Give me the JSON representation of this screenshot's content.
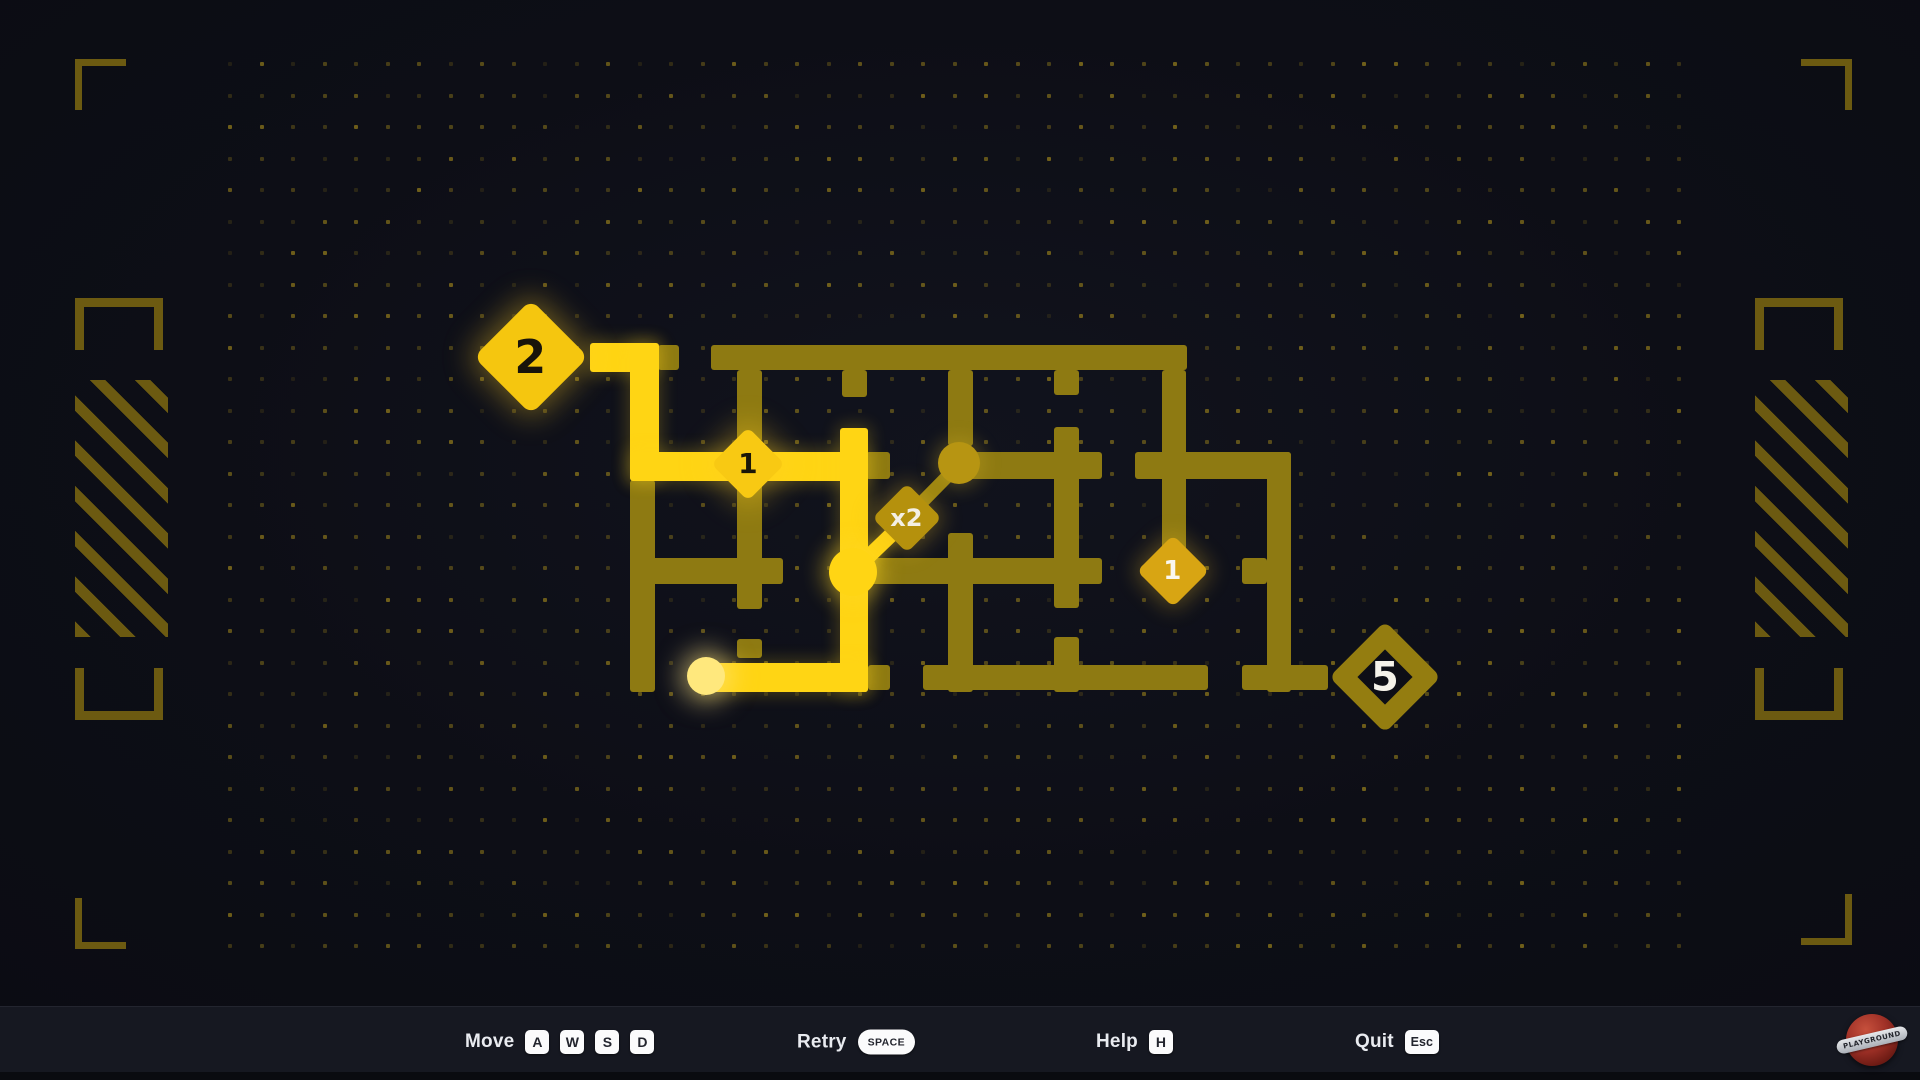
{
  "app": {
    "background": "#0d0e16",
    "footer_background": "#161821",
    "accent_bright": "#ffd514",
    "accent_dim": "#8e7a12",
    "accent_pale": "#ffe87d",
    "decor_color": "#6c5a11"
  },
  "logo": {
    "text": "PLAYGROUND"
  },
  "hud": {
    "controls": [
      {
        "label": "Move",
        "keys": [
          {
            "t": "A"
          },
          {
            "t": "W"
          },
          {
            "t": "S"
          },
          {
            "t": "D"
          }
        ]
      },
      {
        "label": "Retry",
        "keys": [
          {
            "t": "SPACE",
            "style": "pill"
          }
        ]
      },
      {
        "label": "Help",
        "keys": [
          {
            "t": "H"
          }
        ]
      },
      {
        "label": "Quit",
        "keys": [
          {
            "t": "Esc",
            "style": "wide"
          }
        ]
      }
    ]
  },
  "maze": {
    "bright_segments": [
      {
        "x": 590,
        "y": 343,
        "w": 66,
        "h": 29
      },
      {
        "x": 630,
        "y": 343,
        "w": 29,
        "h": 137
      },
      {
        "x": 630,
        "y": 452,
        "w": 238,
        "h": 29
      },
      {
        "x": 840,
        "y": 428,
        "w": 28,
        "h": 264
      },
      {
        "x": 702,
        "y": 663,
        "w": 166,
        "h": 29
      }
    ],
    "dim_segments": [
      {
        "x": 658,
        "y": 345,
        "w": 21,
        "h": 25
      },
      {
        "x": 711,
        "y": 345,
        "w": 476,
        "h": 25
      },
      {
        "x": 842,
        "y": 370,
        "w": 25,
        "h": 27
      },
      {
        "x": 737,
        "y": 370,
        "w": 25,
        "h": 72
      },
      {
        "x": 948,
        "y": 370,
        "w": 25,
        "h": 76
      },
      {
        "x": 1054,
        "y": 370,
        "w": 25,
        "h": 25
      },
      {
        "x": 1162,
        "y": 370,
        "w": 24,
        "h": 201
      },
      {
        "x": 866,
        "y": 452,
        "w": 24,
        "h": 27
      },
      {
        "x": 944,
        "y": 452,
        "w": 158,
        "h": 27
      },
      {
        "x": 1054,
        "y": 427,
        "w": 25,
        "h": 181
      },
      {
        "x": 1135,
        "y": 452,
        "w": 156,
        "h": 27
      },
      {
        "x": 1267,
        "y": 452,
        "w": 24,
        "h": 240
      },
      {
        "x": 630,
        "y": 480,
        "w": 25,
        "h": 212
      },
      {
        "x": 630,
        "y": 558,
        "w": 153,
        "h": 26
      },
      {
        "x": 737,
        "y": 480,
        "w": 25,
        "h": 129
      },
      {
        "x": 737,
        "y": 639,
        "w": 25,
        "h": 19
      },
      {
        "x": 866,
        "y": 558,
        "w": 236,
        "h": 26
      },
      {
        "x": 948,
        "y": 533,
        "w": 25,
        "h": 159
      },
      {
        "x": 1054,
        "y": 637,
        "w": 25,
        "h": 55
      },
      {
        "x": 1242,
        "y": 558,
        "w": 25,
        "h": 26
      },
      {
        "x": 868,
        "y": 665,
        "w": 22,
        "h": 25
      },
      {
        "x": 923,
        "y": 665,
        "w": 285,
        "h": 25
      },
      {
        "x": 1242,
        "y": 665,
        "w": 86,
        "h": 25
      }
    ],
    "diagonals": [
      {
        "x1": 853,
        "y1": 571,
        "x2": 907,
        "y2": 519,
        "w": 15,
        "tone": "bright"
      },
      {
        "x1": 907,
        "y1": 517,
        "x2": 959,
        "y2": 464,
        "w": 13,
        "tone": "dim"
      }
    ],
    "path_dots": [
      {
        "x": 959,
        "y": 463,
        "r": 21,
        "tone": "dimdot"
      },
      {
        "x": 853,
        "y": 572,
        "r": 24,
        "tone": "bright"
      },
      {
        "x": 706,
        "y": 676,
        "r": 19,
        "tone": "pale"
      }
    ],
    "nodes": [
      {
        "x": 531,
        "y": 357,
        "half": 57,
        "fill": "#f5c60f",
        "corner": 10,
        "label": "2",
        "label_color": "#18130a",
        "label_size": 46,
        "glow": "strong",
        "hollow": false
      },
      {
        "x": 748,
        "y": 464,
        "half": 37,
        "fill": "#f8c913",
        "corner": 7,
        "label": "1",
        "label_color": "#1a1608",
        "label_size": 28,
        "glow": "strong",
        "hollow": false
      },
      {
        "x": 907,
        "y": 518,
        "half": 35,
        "fill": "#b5910d",
        "corner": 7,
        "label": "x2",
        "label_color": "#f3efe4",
        "label_size": 24,
        "glow": "soft",
        "hollow": false
      },
      {
        "x": 1173,
        "y": 571,
        "half": 36,
        "fill": "#d8a513",
        "corner": 7,
        "label": "1",
        "label_color": "#faf7ef",
        "label_size": 26,
        "glow": "soft",
        "hollow": false
      },
      {
        "x": 1385,
        "y": 677,
        "half": 56,
        "fill": "#947d10",
        "corner": 8,
        "label": "5",
        "label_color": "#f5f2ea",
        "label_size": 40,
        "glow": "none",
        "hollow": true,
        "stroke": 20,
        "inner": "#0d0e16"
      }
    ]
  },
  "decor": {
    "dot_grid": {
      "x0": 228,
      "y0": 62,
      "step": 31.5,
      "cols": 47,
      "rows": 29,
      "size": 4
    },
    "corner_brackets": [
      {
        "pos": "tl",
        "x": 75,
        "y": 59
      },
      {
        "pos": "tr",
        "x": 1801,
        "y": 59
      },
      {
        "pos": "bl",
        "x": 75,
        "y": 898
      },
      {
        "pos": "br",
        "x": 1801,
        "y": 894
      }
    ],
    "side_columns": [
      {
        "x": 75,
        "bracket_top_y": 298,
        "hatch_y": 380,
        "bracket_bottom_y": 668
      },
      {
        "x": 1755,
        "bracket_top_y": 298,
        "hatch_y": 380,
        "bracket_bottom_y": 668
      }
    ]
  }
}
